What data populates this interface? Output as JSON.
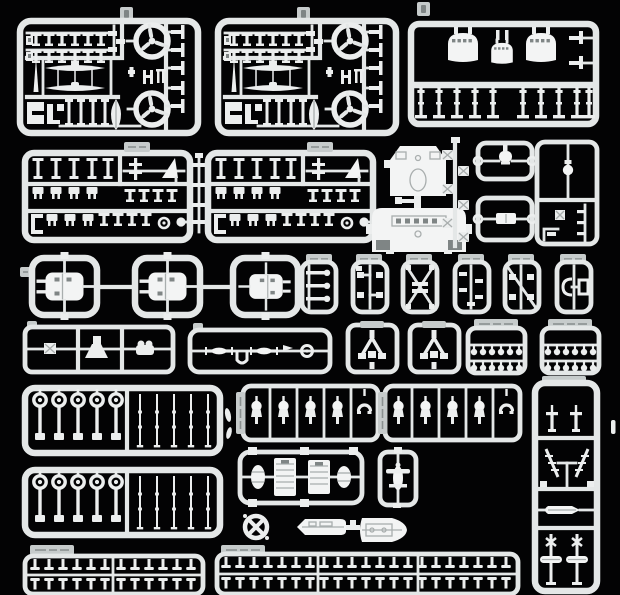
{
  "scene": {
    "title": "Injection-molded model kit sprues",
    "description": "Overhead photo of light-gray plastic model sprues (warship kit parts trees) arranged in rows on a black background",
    "colors": {
      "background": "#030304",
      "sprue": "#e4e7e7",
      "part": "#eceeee",
      "part_bright": "#f3f4f4",
      "detail": "#a9aeae",
      "inset": "#7f8585",
      "chip": "#c6cbcb",
      "chip_mark": "#8a9090"
    },
    "sprues": [
      {
        "id": "A1",
        "name": "fittings-sprue",
        "contents": "two circular propeller runners, two float-plane wing parts, mast needle, rows of small deck fittings, ship's boat",
        "label": "illegible molded code tab"
      },
      {
        "id": "A2",
        "name": "fittings-sprue-duplicate",
        "contents": "identical duplicate of A1",
        "label": "illegible molded code tab"
      },
      {
        "id": "B",
        "name": "turret-housing-sprue",
        "contents": "three rounded turret housings (large, small, large) on a top rail, ten barrel posts with tee feet, two side brackets",
        "label": "illegible molded code tab"
      },
      {
        "id": "C1",
        "name": "small-fittings-sprue",
        "contents": "three shelves of tee beams, boxes and brackets, ring and ball parts",
        "label": "illegible molded code tab"
      },
      {
        "id": "C2",
        "name": "small-fittings-sprue-duplicate",
        "contents": "identical duplicate of C1",
        "label": "illegible molded code tab"
      },
      {
        "id": "bar-strip",
        "name": "bar-strip",
        "contents": "four small bars on a vertical runner"
      },
      {
        "id": "D",
        "name": "superstructure-parts",
        "contents": "two bridge deck pieces joined by a short vertical runner"
      },
      {
        "id": "E",
        "name": "ladder-strip",
        "contents": "six small boxes staggered along a vertical runner"
      },
      {
        "id": "F1",
        "name": "small-frame-top",
        "contents": "one rounded fitting with side ring gates"
      },
      {
        "id": "F2",
        "name": "small-frame-bottom",
        "contents": "one rectangular fitting with side ring gates"
      },
      {
        "id": "G",
        "name": "tall-corner-frame",
        "contents": "capstan part, corner runners, three small bars and a boxed part"
      },
      {
        "id": "H",
        "name": "turret-chain",
        "contents": "three linked square frames each holding one secondary gun turret",
        "label": "illegible molded code tab"
      },
      {
        "id": "I1",
        "name": "mini-sprue-1",
        "contents": "three barred parts with round knobs",
        "label": "illegible"
      },
      {
        "id": "I2",
        "name": "mini-sprue-2",
        "contents": "four tiny mounts on a center runner",
        "label": "illegible"
      },
      {
        "id": "I3",
        "name": "mini-sprue-3",
        "contents": "small parts on X diagonal runners",
        "label": "illegible"
      },
      {
        "id": "I4",
        "name": "mini-sprue-4",
        "contents": "five tiny fittings staggered on a center runner",
        "label": "illegible"
      },
      {
        "id": "I5",
        "name": "mini-sprue-5",
        "contents": "four tiny mounts with one diagonal runner",
        "label": "illegible"
      },
      {
        "id": "I6",
        "name": "mini-sprue-6",
        "contents": "bracket pair on a center runner",
        "label": "illegible"
      },
      {
        "id": "J",
        "name": "three-cell-frame",
        "contents": "boxed part, wedge ramp, twin round-top mount",
        "label": "illegible"
      },
      {
        "id": "K",
        "name": "shaft-sprue",
        "contents": "two finned spindles, U pipe, pennant, wheel ring",
        "label": "illegible"
      },
      {
        "id": "L1",
        "name": "vee-strut-frame",
        "contents": "vee strut part under a molded top plate"
      },
      {
        "id": "L2",
        "name": "vee-strut-frame-duplicate",
        "contents": "identical duplicate of L1"
      },
      {
        "id": "M1",
        "name": "depth-charge-rack",
        "contents": "two rows of six ball-head pins",
        "label": "illegible"
      },
      {
        "id": "M2",
        "name": "depth-charge-rack-duplicate",
        "contents": "two rows of six ball-head pins",
        "label": "illegible"
      },
      {
        "id": "N1",
        "name": "searchlight-and-rod-sprue",
        "contents": "five ringed posts and five thin rods"
      },
      {
        "id": "N2",
        "name": "searchlight-and-rod-sprue-duplicate",
        "contents": "identical duplicate of N1"
      },
      {
        "id": "P1",
        "name": "gun-mount-strip",
        "contents": "five shielded round mounts in cells",
        "label": "illegible vertical tab"
      },
      {
        "id": "P2",
        "name": "gun-mount-strip-duplicate",
        "contents": "five shielded round mounts in cells",
        "label": "illegible vertical tab"
      },
      {
        "id": "Q",
        "name": "tall-accessory-sprue",
        "contents": "tee posts, two comb ladders, small boat, two floats on cross posts",
        "label": "illegible"
      },
      {
        "id": "R",
        "name": "deck-sprue",
        "contents": "two hatched deck panels and two oval platforms"
      },
      {
        "id": "S",
        "name": "single-part-frame",
        "contents": "one winged fitting"
      },
      {
        "id": "T",
        "name": "ring-part",
        "contents": "circular base with X spokes"
      },
      {
        "id": "U",
        "name": "hull-pair",
        "contents": "two small hull halves joined by a runner"
      },
      {
        "id": "V1",
        "name": "vent-strip",
        "contents": "two rows of twelve tee vents",
        "label": "illegible"
      },
      {
        "id": "V2",
        "name": "vent-strip-long",
        "contents": "two rows of twenty-one tee vents",
        "label": "illegible"
      },
      {
        "id": "debris",
        "name": "loose-bits",
        "contents": "two leaf-shaped gates and a small pin"
      }
    ]
  }
}
